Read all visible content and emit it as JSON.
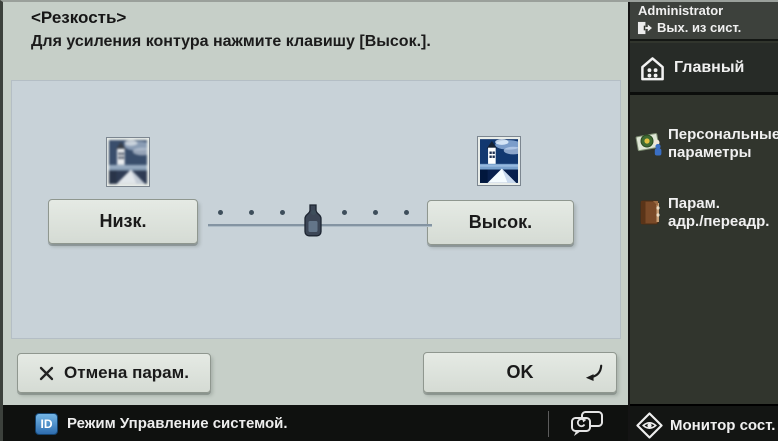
{
  "panel": {
    "title": "<Резкость>",
    "subtitle": "Для усиления контура нажмите клавишу [Высок.]."
  },
  "slider": {
    "low_label": "Низк.",
    "high_label": "Высок.",
    "steps": 7,
    "value": 4
  },
  "previews": {
    "low_icon": "blurry-house-photo",
    "high_icon": "sharp-house-photo"
  },
  "footer": {
    "cancel_label": "Отмена парам.",
    "ok_label": "OK"
  },
  "status_bar": {
    "id_badge": "ID",
    "mode_text": "Режим Управление системой."
  },
  "sidebar": {
    "user_name": "Administrator",
    "logout_label": "Вых. из сист.",
    "home_label": "Главный",
    "items": [
      {
        "line1": "Персональные",
        "line2": "параметры",
        "icon": "personal-settings-icon"
      },
      {
        "line1": "Парам.",
        "line2": "адр./переадр.",
        "icon": "address-book-icon"
      }
    ],
    "monitor_label": "Монитор сост."
  },
  "colors": {
    "main_bg": "#c6cfc8",
    "inner_panel_bg": "#c8d2d8",
    "sidebar_bg": "#31352d",
    "statusbar_bg": "#0f110f",
    "id_badge_blue": "#2e6dae",
    "knob_navy": "#3c4656"
  }
}
